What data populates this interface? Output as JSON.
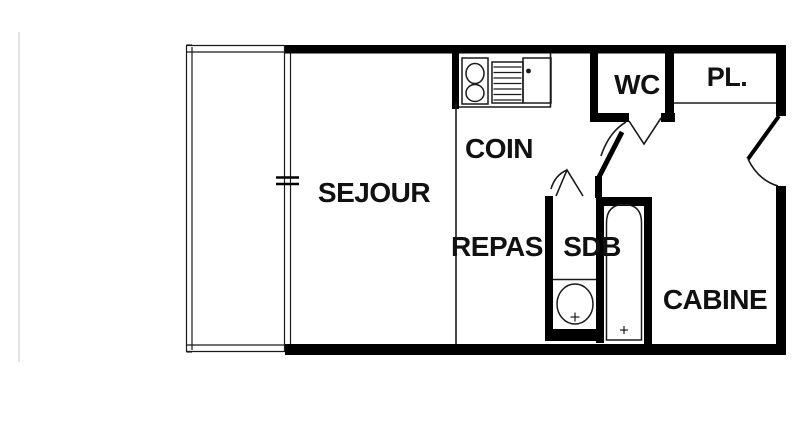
{
  "plan": {
    "title": "studio-floor-plan",
    "colors": {
      "bg": "#ffffff",
      "wall": "#000000",
      "line": "#1a1a1a",
      "faint": "#d9d9d9",
      "label": "#111111"
    },
    "rooms": {
      "sejour": {
        "label": "SEJOUR"
      },
      "coin": {
        "label": "COIN"
      },
      "repas": {
        "label": "REPAS"
      },
      "wc": {
        "label": "WC"
      },
      "placard": {
        "label": "PL."
      },
      "sdb": {
        "label": "SDB"
      },
      "cabine": {
        "label": "CABINE"
      }
    },
    "fixtures": {
      "kitchen_sink": "double-sink-unit",
      "stove": "cooker-grill",
      "worktop": "counter-top",
      "washbasin": "round-basin",
      "bathtub": "bathtub",
      "balcony": "balcony-railing",
      "window": "window-marker",
      "doors": [
        "entry-door",
        "wc-door",
        "sdb-door"
      ]
    }
  }
}
